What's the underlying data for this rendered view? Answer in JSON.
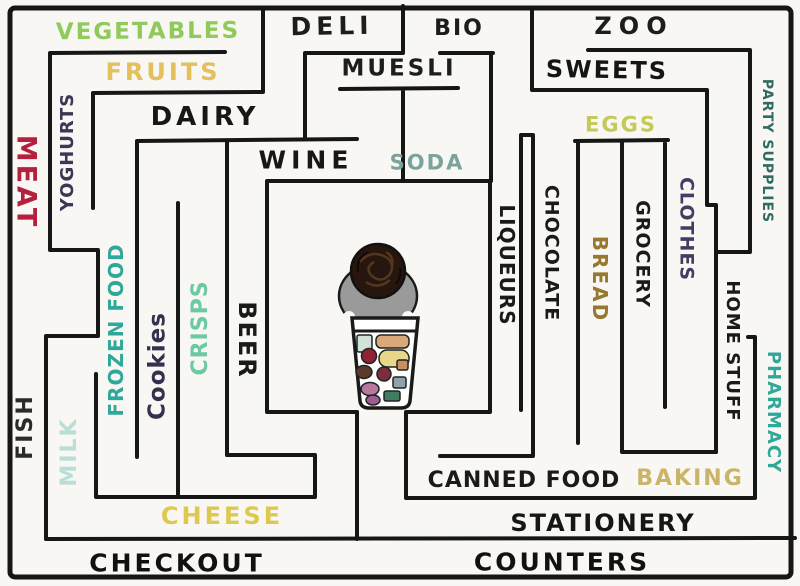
{
  "map": {
    "kind": "hand-drawn supermarket maze floor plan",
    "wall_color": "#161616",
    "paper_color": "#f8f7f3"
  },
  "labels": {
    "vegetables": {
      "text": "VEGETABLES",
      "color": "#8fca5a"
    },
    "fruits": {
      "text": "FRUITS",
      "color": "#e3c05c"
    },
    "deli": {
      "text": "DELI",
      "color": "#1d1d1d"
    },
    "bio": {
      "text": "BIO",
      "color": "#1d1d1d"
    },
    "zoo": {
      "text": "ZOO",
      "color": "#1d1d1d"
    },
    "muesli": {
      "text": "MUESLI",
      "color": "#1d1d1d"
    },
    "sweets": {
      "text": "SWEETS",
      "color": "#151515"
    },
    "dairy": {
      "text": "DAIRY",
      "color": "#171717"
    },
    "wine": {
      "text": "WINE",
      "color": "#171717"
    },
    "soda": {
      "text": "SODA",
      "color": "#7ba39b"
    },
    "eggs": {
      "text": "EGGS",
      "color": "#c5c95a"
    },
    "meat": {
      "text": "MEAT",
      "color": "#b5203c"
    },
    "yoghurts": {
      "text": "YOGHURTS",
      "color": "#3d3655"
    },
    "fish": {
      "text": "FISH",
      "color": "#2b2b2b"
    },
    "milk": {
      "text": "MILK",
      "color": "#b8ded6"
    },
    "frozen_food": {
      "text": "FROZEN FOOD",
      "color": "#2fa89a"
    },
    "cookies": {
      "text": "Cookies",
      "color": "#35304d"
    },
    "crisps": {
      "text": "CRISPS",
      "color": "#6cc9a4"
    },
    "beer": {
      "text": "BEER",
      "color": "#1a1a1a"
    },
    "liqueurs": {
      "text": "LIQUEURS",
      "color": "#1a1a1a"
    },
    "chocolate": {
      "text": "CHOCOLATE",
      "color": "#1a1a1a"
    },
    "bread": {
      "text": "BREAD",
      "color": "#96782e"
    },
    "grocery": {
      "text": "GROCERY",
      "color": "#1a1a1a"
    },
    "clothes": {
      "text": "CLOTHES",
      "color": "#433d63"
    },
    "home_stuff": {
      "text": "HOME STUFF",
      "color": "#1a1a1a"
    },
    "pharmacy": {
      "text": "PHARMACY",
      "color": "#2fa89a"
    },
    "party_supplies": {
      "text": "PARTY SUPPLIES",
      "color": "#2f6b62"
    },
    "cheese": {
      "text": "CHEESE",
      "color": "#ddc94f"
    },
    "canned_food": {
      "text": "CANNED FOOD",
      "color": "#1a1a1a"
    },
    "baking": {
      "text": "BAKING",
      "color": "#c9b46a"
    },
    "stationery": {
      "text": "STATIONERY",
      "color": "#161616"
    },
    "checkout": {
      "text": "CHECKOUT",
      "color": "#111111"
    },
    "counters": {
      "text": "COUNTERS",
      "color": "#111111"
    }
  },
  "figure": {
    "head_color": "#26160e",
    "hair_scribble_color": "#5a3a22",
    "body_color": "#9a9a9a",
    "cart_fill": "#ffffff",
    "cart_outline": "#1a1a1a",
    "cart_items": {
      "mint": "#cfe3d8",
      "tan": "#d9a878",
      "maroon": "#8e2333",
      "cream": "#e8d689",
      "brown": "#5a3a28",
      "maroon2": "#7e2d3f",
      "pink": "#b77a9e",
      "slate": "#8fa3ad",
      "green": "#3e7d62",
      "purple": "#9c5d8f",
      "tan2": "#c98f5e"
    }
  }
}
